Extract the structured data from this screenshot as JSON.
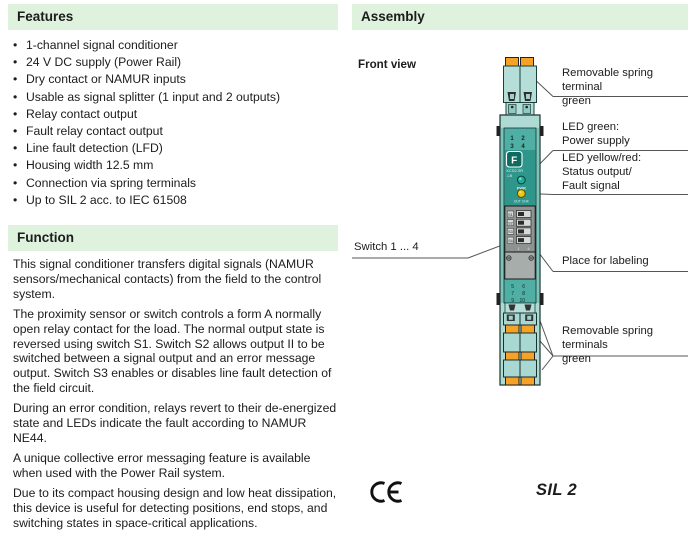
{
  "features": {
    "title": "Features",
    "items": [
      "1-channel signal conditioner",
      "24 V DC supply (Power Rail)",
      "Dry contact or NAMUR inputs",
      "Usable as signal splitter (1 input and 2 outputs)",
      "Relay contact output",
      "Fault relay contact output",
      "Line fault detection (LFD)",
      "Housing width 12.5 mm",
      "Connection via spring terminals",
      "Up to SIL 2 acc. to IEC 61508"
    ]
  },
  "function": {
    "title": "Function",
    "paragraphs": [
      "This signal conditioner transfers digital signals (NAMUR sensors/mechanical contacts) from the field to the control system.",
      "The proximity sensor or switch controls a form A normally open relay contact for the load. The normal output state is reversed using switch S1. Switch S2 allows output II to be switched between a signal output and an error message output. Switch S3 enables or disables line fault detection of the field circuit.",
      "During an error condition, relays revert to their de-energized state and LEDs indicate the fault according to NAMUR NE44.",
      "A unique collective error messaging feature is available when used with the Power Rail system.",
      "Due to its compact housing design and low heat dissipation, this device is useful for detecting positions, end stops, and switching states in space-critical applications."
    ]
  },
  "assembly": {
    "title": "Assembly",
    "front_view": "Front view",
    "callouts": {
      "terminal_top": "Removable spring terminal\ngreen",
      "led_green": "LED green:\nPower supply",
      "led_yellow": "LED yellow/red:\nStatus output/\nFault signal",
      "switches": "Switch 1 ... 4",
      "labeling": "Place for labeling",
      "terminals_bottom": "Removable spring terminals\ngreen"
    },
    "device": {
      "channel_numbers": [
        "1",
        "2",
        "3",
        "4"
      ],
      "terminal_numbers": [
        "5",
        "6",
        "7",
        "8",
        "9",
        "10"
      ],
      "brand_logo": "F",
      "model_line1": "KCD2-SR",
      "model_line2": ".LB",
      "led_green_label": "PWR",
      "led_yellow_label": "OUT CHK",
      "dip_labels": [
        "S1",
        "S2",
        "S3",
        "S4"
      ],
      "dip_range_start": "1",
      "dip_range_end": "4"
    },
    "ce_mark": "CE",
    "sil_badge": "SIL 2"
  },
  "colors": {
    "section_header_bg": "#def2de",
    "device_teal_light": "#b5ded8",
    "device_teal_mid": "#4fafa4",
    "device_teal_dark": "#2f968b",
    "terminal_orange": "#f5a328",
    "led_green": "#1fae9d",
    "led_yellow": "#ecc715"
  }
}
